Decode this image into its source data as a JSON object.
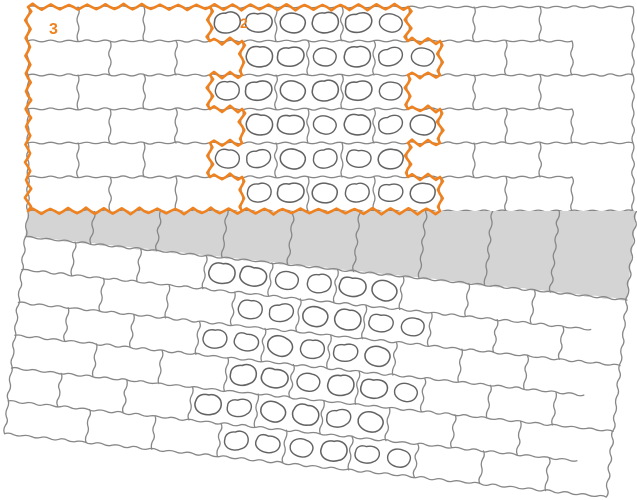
{
  "figure": {
    "name": "paver-laying-pattern-diagram",
    "background": "#ffffff",
    "colors": {
      "outline_orange": "#EF811E",
      "joint_gray": "#878787",
      "blob_gray": "#636363",
      "band_fill": "#D4D4D4",
      "paver_fill": "#FFFFFF"
    },
    "labels": [
      {
        "text": "3",
        "x": 49,
        "y": 22,
        "font_size": 16
      },
      {
        "text": "2",
        "x": 240,
        "y": 16,
        "font_size": 14
      }
    ],
    "pattern": {
      "canvas": {
        "width": 637,
        "height": 500
      },
      "tile": {
        "width": 66,
        "height": 34
      },
      "top_grid": {
        "left": 28,
        "top": 7,
        "right": 633,
        "bottom": 211,
        "rows": 6,
        "even_row_first_joint": 78,
        "odd_row_first_joint": 110,
        "joint_max_x": 575,
        "short_boundary_end": 572
      },
      "region_plain": {
        "label": "3",
        "rows": 6,
        "left": 28,
        "right_even": 210,
        "right_odd": 242
      },
      "region_decor": {
        "label": "2",
        "rows": 6,
        "tiles_per_row": 3,
        "blobs_per_tile": 2,
        "left_even": 210,
        "left_odd": 242,
        "right_even": 408,
        "right_odd": 440
      },
      "bottom_grid": {
        "rotation_deg": 6,
        "pivot_x": 28,
        "pivot_y": 211,
        "left": 28,
        "right": 633,
        "gray_row": {
          "fill_top": 140,
          "bottom": 237,
          "joint_start": 94,
          "joint_step": 66
        },
        "rows": 6,
        "row_height": 33,
        "even_row_first_joint": 78,
        "odd_row_first_joint": 110,
        "joint_max_x": 575,
        "short_boundary_end": 600,
        "band_left_odd_rows": 210,
        "band_left_even_rows": 242,
        "band_tiles_per_row": 3
      }
    }
  }
}
